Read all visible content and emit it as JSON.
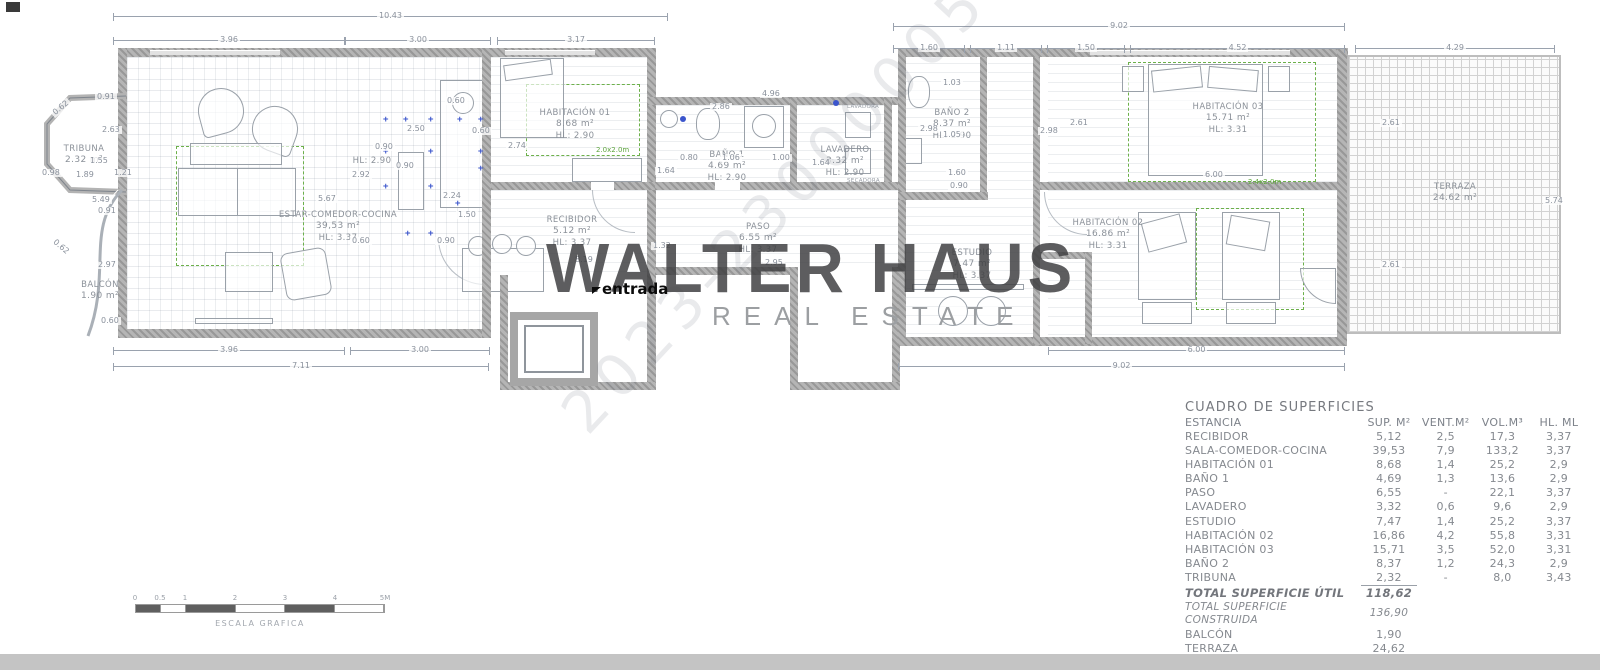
{
  "watermark": {
    "brand": "WALTER HAUS",
    "sub": "REAL ESTATE",
    "serial": "2023-23000005"
  },
  "entrada_label": "entrada",
  "rooms": {
    "tribuna": {
      "name": "TRIBUNA",
      "area": "2.32 m²"
    },
    "balcon": {
      "name": "BALCÓN",
      "area": "1.90 m²"
    },
    "estar": {
      "name": "ESTAR-COMEDOR-COCINA",
      "area": "39,53 m²",
      "hl": "HL: 3.37"
    },
    "cocina_hl": "HL: 2.90",
    "hab01": {
      "name": "HABITACIÓN 01",
      "area": "8.68 m²",
      "hl": "HL: 2.90",
      "mark": "2.0x2.0m"
    },
    "recibidor": {
      "name": "RECIBIDOR",
      "area": "5.12 m²",
      "hl": "HL: 3.37"
    },
    "bano1": {
      "name": "BAÑO 1",
      "area": "4.69 m²",
      "hl": "HL: 2.90"
    },
    "paso": {
      "name": "PASO",
      "area": "6.55 m²",
      "hl": "HL: 3.37"
    },
    "lavadero": {
      "name": "LAVADERO",
      "area": "3.32 m²",
      "hl": "HL: 2.90",
      "appliance1": "LAVADORA",
      "appliance2": "SECADORA"
    },
    "bano2": {
      "name": "BAÑO 2",
      "area": "8.37 m²",
      "hl": "HL: 2.90"
    },
    "hab03": {
      "name": "HABITACIÓN 03",
      "area": "15.71 m²",
      "hl": "HL: 3.31",
      "mark": "2.4x2.0m"
    },
    "hab02": {
      "name": "HABITACIÓN 02",
      "area": "16.86 m²",
      "hl": "HL: 3.31"
    },
    "estudio": {
      "name": "ESTUDIO",
      "area": "7.47 m²",
      "hl": "HL: 3.37"
    },
    "terraza": {
      "name": "TERRAZA",
      "area": "24.62 m²"
    }
  },
  "dims": [
    "10.43",
    "3.96",
    "3.00",
    "3.17",
    "9.02",
    "1.60",
    "1.11",
    "1.50",
    "4.52",
    "4.29",
    "3.96",
    "3.00",
    "7.11",
    "6.00",
    "9.02",
    "0.91",
    "2.63",
    "1.55",
    "1.89",
    "0.98",
    "1.21",
    "0.62",
    "0.62",
    "5.49",
    "0.91",
    "2.97",
    "0.60",
    "5.67",
    "0.60",
    "2.50",
    "0.60",
    "0.90",
    "0.90",
    "2.92",
    "2.24",
    "1.50",
    "0.60",
    "0.90",
    "2.74",
    "4.96",
    "2.86",
    "0.80",
    "1.06",
    "1.00",
    "1.64",
    "1.64",
    "1.32",
    "8.19",
    "2.95",
    "1.03",
    "2.98",
    "1.05",
    "2.98",
    "2.61",
    "1.60",
    "0.90",
    "6.00",
    "2.61",
    "2.61",
    "5.74"
  ],
  "table": {
    "title": "CUADRO DE SUPERFICIES",
    "headers": [
      "ESTANCIA",
      "SUP. M²",
      "VENT.M²",
      "VOL.M³",
      "HL. ML"
    ],
    "rows": [
      [
        "RECIBIDOR",
        "5,12",
        "2,5",
        "17,3",
        "3,37"
      ],
      [
        "SALA-COMEDOR-COCINA",
        "39,53",
        "7,9",
        "133,2",
        "3,37"
      ],
      [
        "HABITACIÓN 01",
        "8,68",
        "1,4",
        "25,2",
        "2,9"
      ],
      [
        "BAÑO 1",
        "4,69",
        "1,3",
        "13,6",
        "2,9"
      ],
      [
        "PASO",
        "6,55",
        "-",
        "22,1",
        "3,37"
      ],
      [
        "LAVADERO",
        "3,32",
        "0,6",
        "9,6",
        "2,9"
      ],
      [
        "ESTUDIO",
        "7,47",
        "1,4",
        "25,2",
        "3,37"
      ],
      [
        "HABITACIÓN 02",
        "16,86",
        "4,2",
        "55,8",
        "3,31"
      ],
      [
        "HABITACIÓN 03",
        "15,71",
        "3,5",
        "52,0",
        "3,31"
      ],
      [
        "BAÑO 2",
        "8,37",
        "1,2",
        "24,3",
        "2,9"
      ],
      [
        "TRIBUNA",
        "2,32",
        "-",
        "8,0",
        "3,43"
      ]
    ],
    "totals": [
      [
        "TOTAL SUPERFICIE ÚTIL",
        "118,62"
      ],
      [
        "TOTAL SUPERFICIE CONSTRUIDA",
        "136,90"
      ],
      [
        "BALCÓN",
        "1,90"
      ],
      [
        "TERRAZA",
        "24,62"
      ]
    ]
  },
  "scalebar": {
    "labels": [
      "0",
      "0.5",
      "1",
      "2",
      "3",
      "4",
      "5M"
    ],
    "caption": "ESCALA GRAFICA"
  }
}
